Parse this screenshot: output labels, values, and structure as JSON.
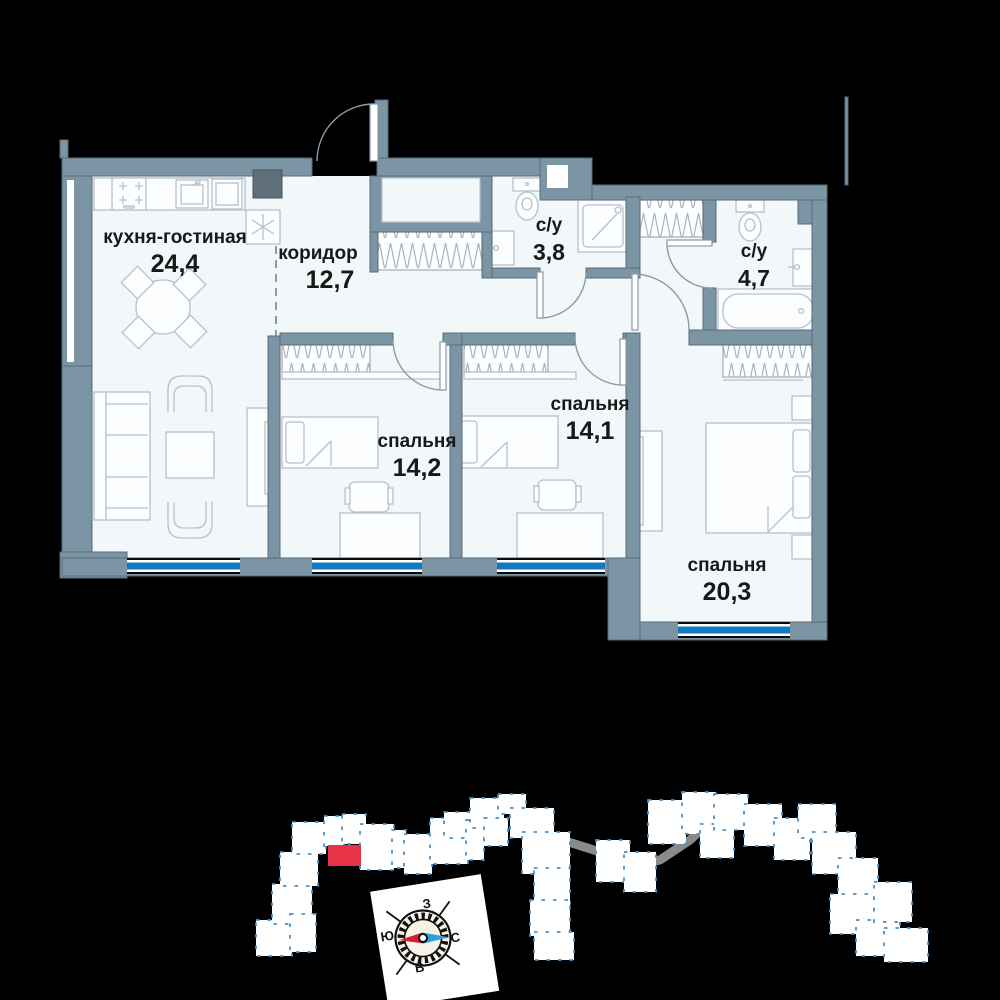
{
  "plan": {
    "rooms": [
      {
        "id": "kitchen-living",
        "name": "кухня-гостиная",
        "area": "24,4"
      },
      {
        "id": "corridor",
        "name": "коридор",
        "area": "12,7"
      },
      {
        "id": "bathroom-small",
        "name": "с/у",
        "area": "3,8"
      },
      {
        "id": "bathroom-large",
        "name": "с/у",
        "area": "4,7"
      },
      {
        "id": "bedroom-1",
        "name": "спальня",
        "area": "14,2"
      },
      {
        "id": "bedroom-2",
        "name": "спальня",
        "area": "14,1"
      },
      {
        "id": "bedroom-3",
        "name": "спальня",
        "area": "20,3"
      }
    ]
  },
  "compass": {
    "top": "З",
    "left": "Ю",
    "right": "С",
    "bottom": "В"
  },
  "colors": {
    "background": "#000000",
    "wall": "#7c95a5",
    "floor": "#f2f7fa",
    "window": "#1478be",
    "highlight": "#e73347",
    "compass_red": "#d6202f",
    "compass_blue": "#2e9fd8"
  }
}
